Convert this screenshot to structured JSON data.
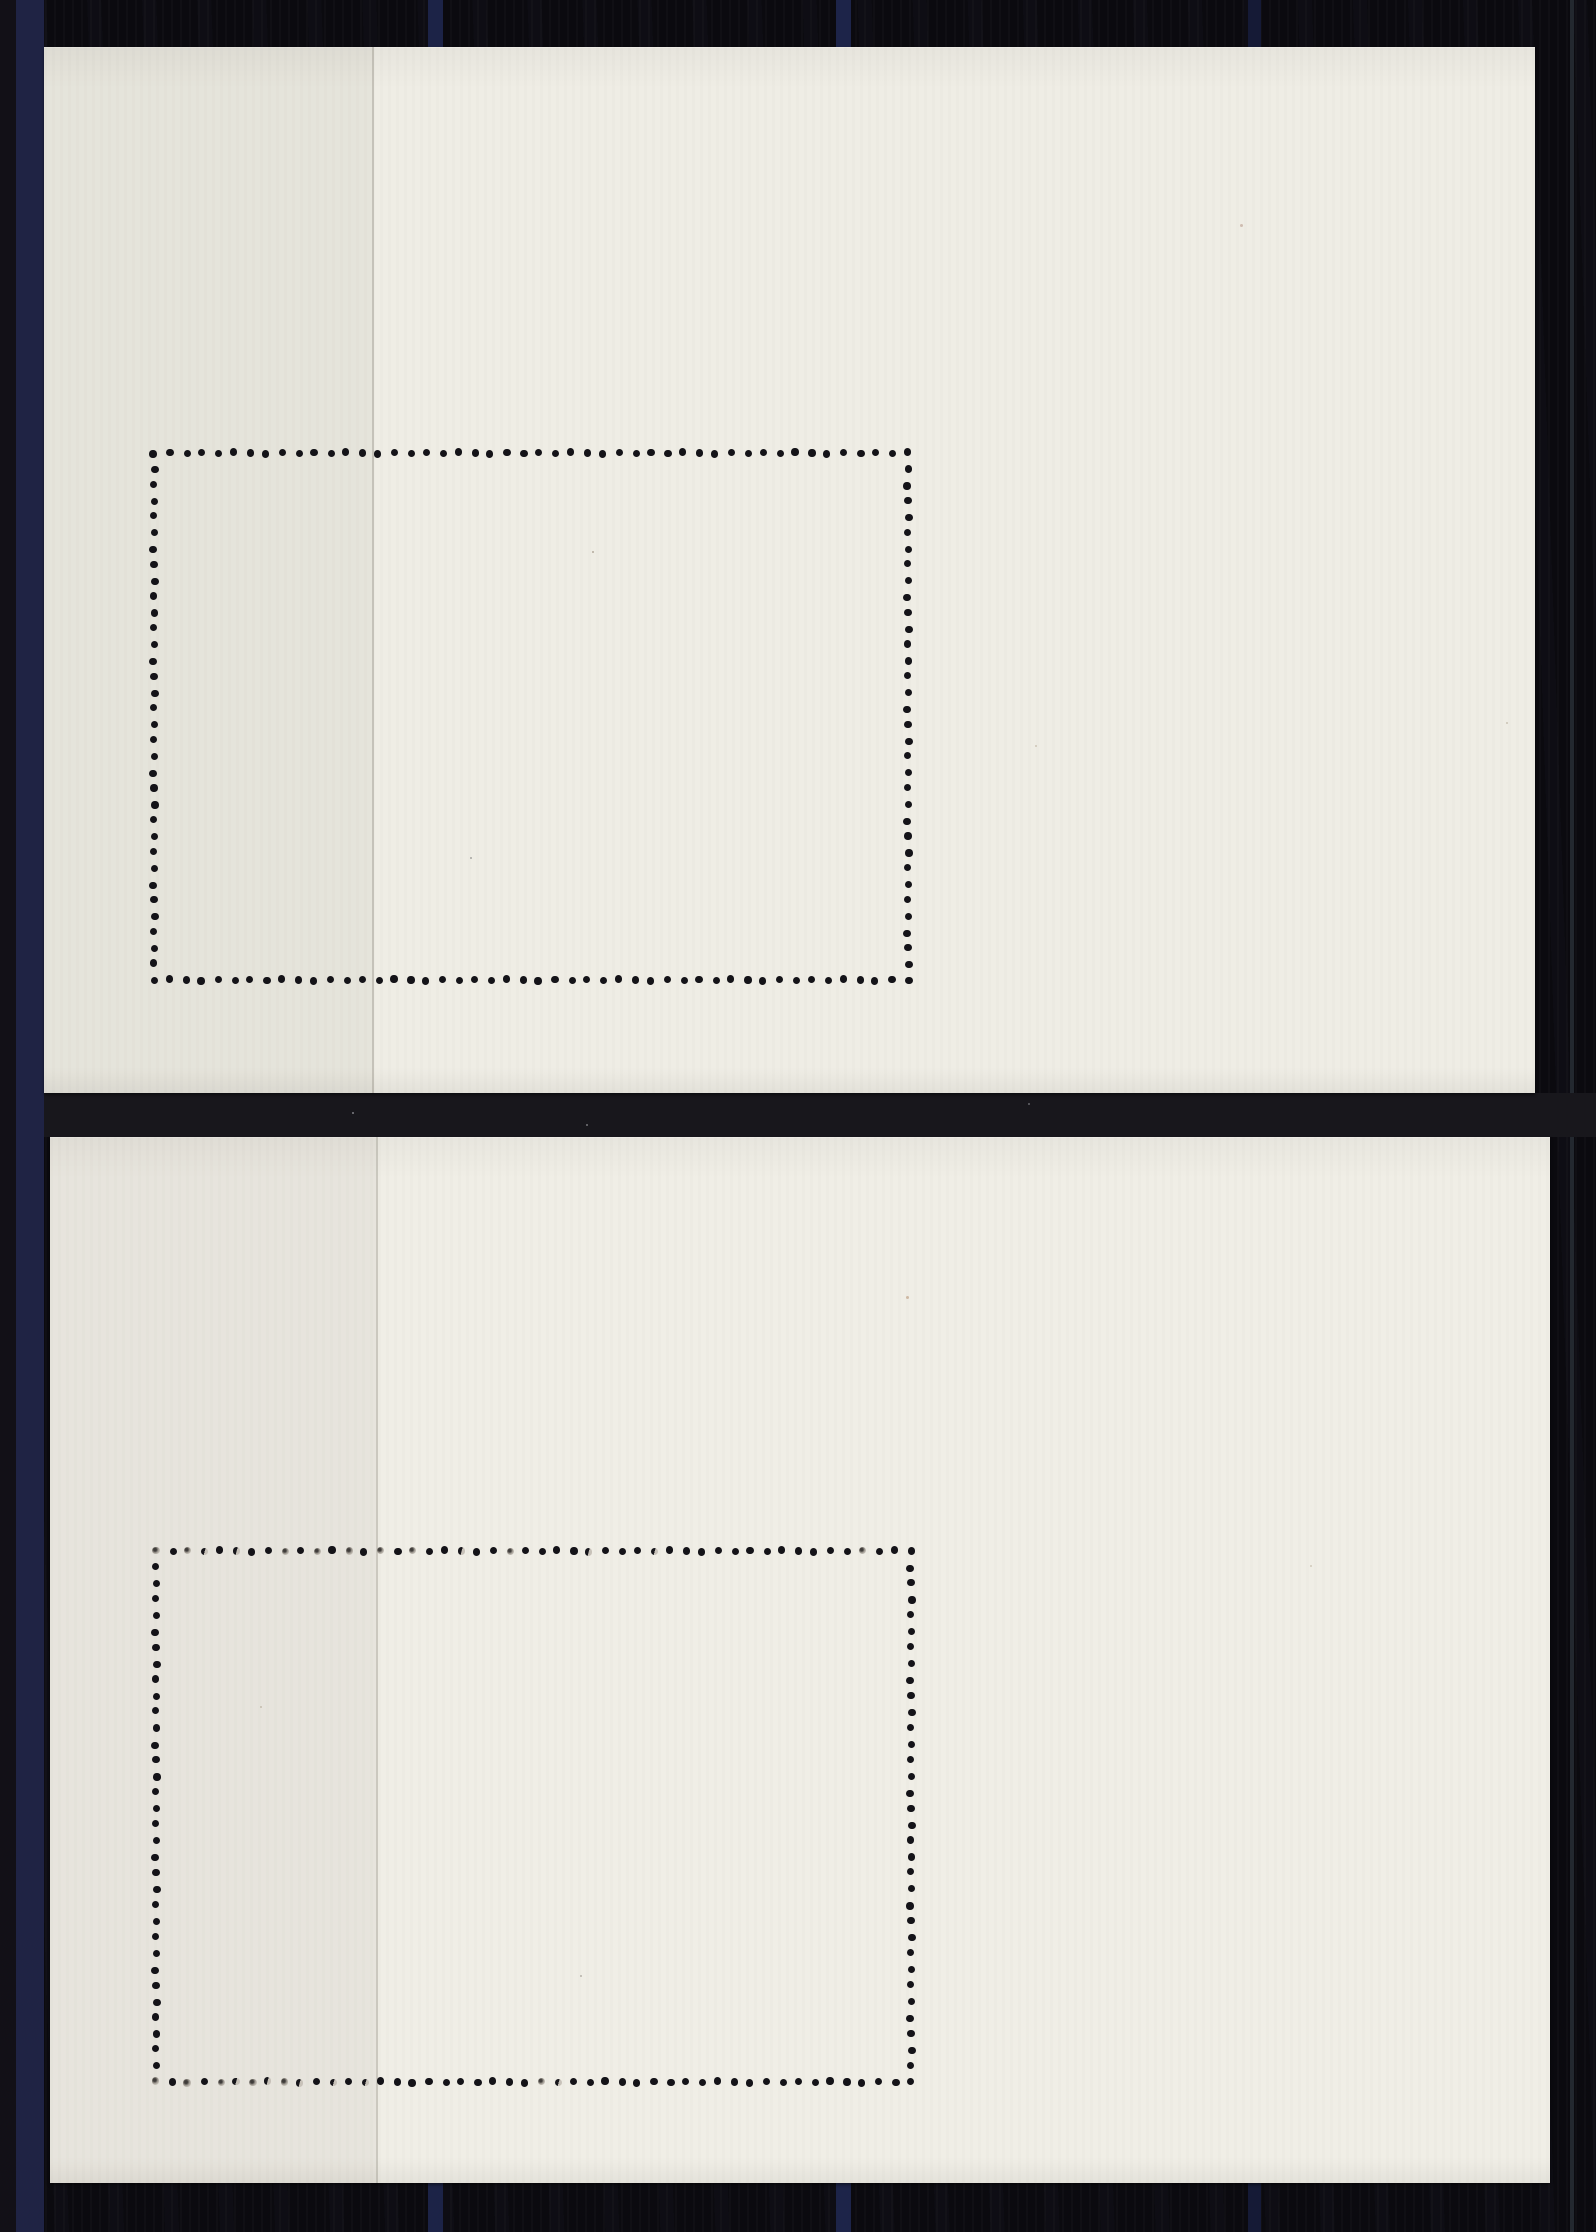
{
  "scene": {
    "width": 1596,
    "height": 2232,
    "description": "Scan of the backs of two blank cream souvenir stamp sheets with rectangular perforation hole outlines, mounted on a dark navy-striped stock album page",
    "base_color": "#0b0a0f"
  },
  "background": {
    "stripes": [
      {
        "x": 0,
        "width": 16,
        "color": "#121017"
      },
      {
        "x": 16,
        "width": 28,
        "color": "#1f2344"
      },
      {
        "x": 428,
        "width": 15,
        "color": "#1c2347"
      },
      {
        "x": 836,
        "width": 15,
        "color": "#1d2449"
      },
      {
        "x": 1248,
        "width": 13,
        "color": "#151a36"
      },
      {
        "x": 1570,
        "width": 4,
        "color": "#23282f"
      }
    ],
    "gap_band": {
      "x": 44,
      "y": 1093,
      "width": 1552,
      "height": 44,
      "color": "#18171c"
    }
  },
  "perforation_style": {
    "dot_color": "#141318",
    "dot_diameter": 7.2,
    "dots_per_row": 48,
    "dots_per_column": 34
  },
  "sheets": [
    {
      "id": "top",
      "x": 44,
      "y": 47,
      "width": 1491,
      "height": 1046,
      "paper_color": "#efede5",
      "seam_x": 372,
      "seam_color": "rgba(125,120,110,0.35)",
      "left_shade_color": "rgba(70,68,62,0.055)",
      "perf": {
        "x": 154,
        "y": 453,
        "width": 754,
        "height": 527
      },
      "faded_top": [],
      "faded_bottom": []
    },
    {
      "id": "bottom",
      "x": 50,
      "y": 1137,
      "width": 1500,
      "height": 1046,
      "paper_color": "#f0eee6",
      "seam_x": 376,
      "seam_color": "rgba(125,120,110,0.32)",
      "left_shade_color": "rgba(70,68,62,0.05)",
      "perf": {
        "x": 156,
        "y": 1551,
        "width": 755,
        "height": 531
      },
      "faded_top": [
        0,
        2,
        3,
        5,
        8,
        10,
        12,
        14,
        16,
        19,
        22,
        27,
        31,
        44
      ],
      "faded_bottom": [
        0,
        2,
        4,
        5,
        6,
        7,
        8,
        9,
        11,
        13,
        24,
        25
      ]
    }
  ],
  "specks": [
    {
      "x": 592,
      "y": 551,
      "size": 2,
      "color": "rgba(90,70,50,0.4)"
    },
    {
      "x": 1240,
      "y": 224,
      "size": 3,
      "color": "rgba(150,100,80,0.35)"
    },
    {
      "x": 470,
      "y": 857,
      "size": 2,
      "color": "rgba(60,60,60,0.4)"
    },
    {
      "x": 1035,
      "y": 745,
      "size": 2,
      "color": "rgba(130,110,80,0.3)"
    },
    {
      "x": 1506,
      "y": 722,
      "size": 2,
      "color": "rgba(120,100,70,0.3)"
    },
    {
      "x": 906,
      "y": 1296,
      "size": 3,
      "color": "rgba(160,110,70,0.4)"
    },
    {
      "x": 580,
      "y": 1975,
      "size": 2,
      "color": "rgba(80,70,60,0.35)"
    },
    {
      "x": 260,
      "y": 1706,
      "size": 2,
      "color": "rgba(120,100,70,0.3)"
    },
    {
      "x": 1310,
      "y": 1565,
      "size": 2,
      "color": "rgba(140,120,90,0.3)"
    },
    {
      "x": 352,
      "y": 1112,
      "size": 2,
      "color": "rgba(230,230,235,0.5)"
    },
    {
      "x": 586,
      "y": 1124,
      "size": 2,
      "color": "rgba(230,230,235,0.45)"
    },
    {
      "x": 1028,
      "y": 1103,
      "size": 2,
      "color": "rgba(220,220,225,0.4)"
    }
  ]
}
